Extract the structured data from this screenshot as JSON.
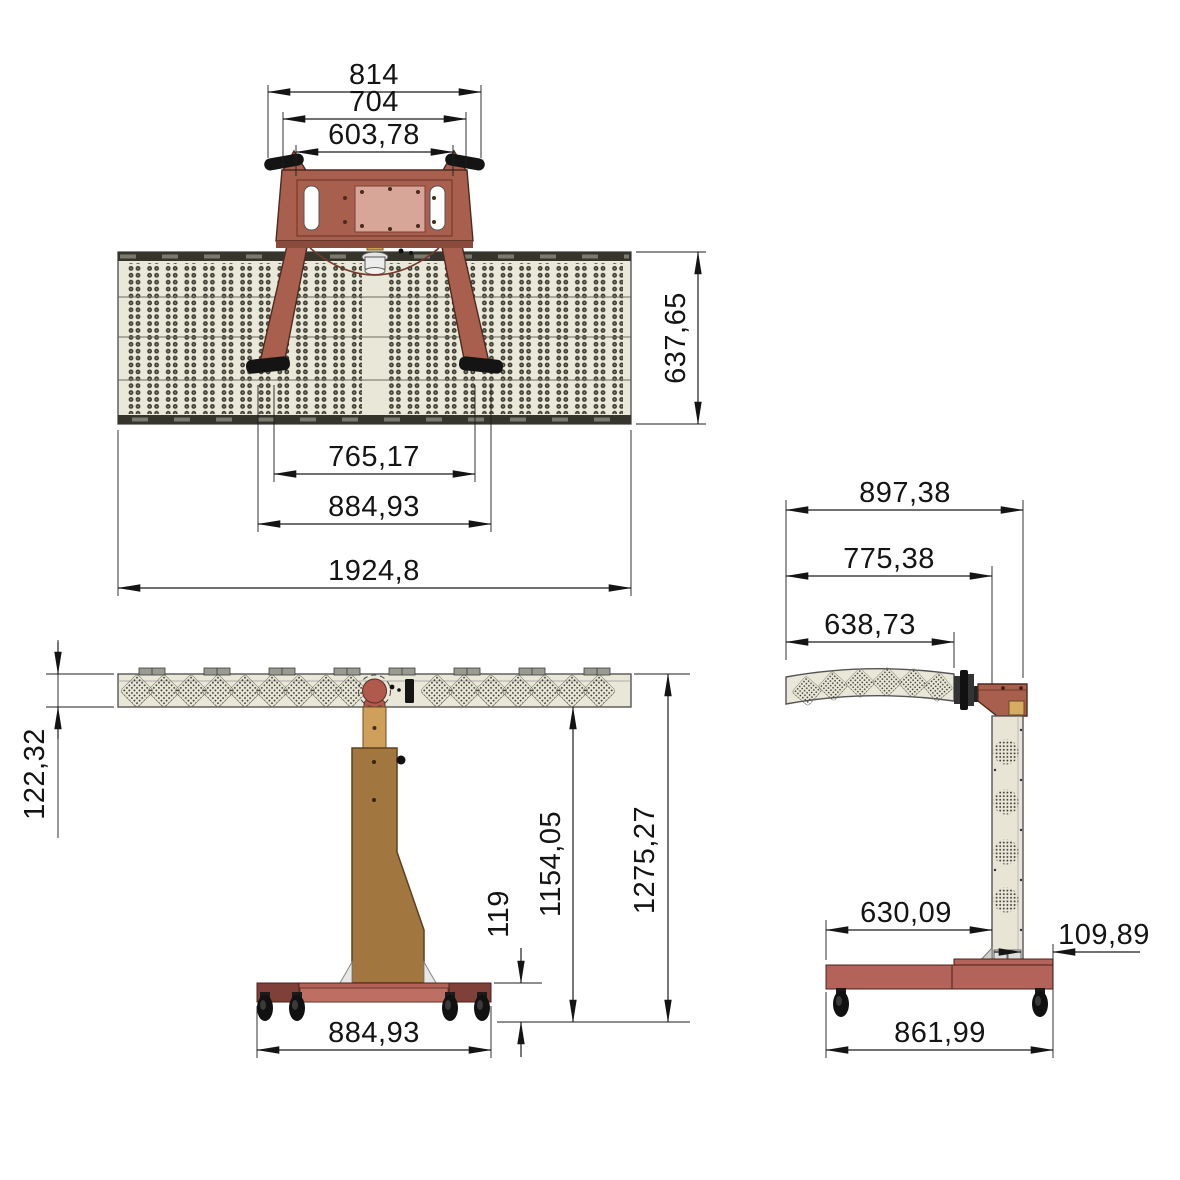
{
  "colors": {
    "bracket_red": "#a85f4e",
    "plate_pink": "#d7a699",
    "panel_cream": "#eae8d9",
    "bar_cream": "#e9e7d8",
    "side_column_cream": "#e8e5d6",
    "column_brown": "#a1773f",
    "adapter_tan": "#cfa05c",
    "base_red": "#b4635a",
    "base_end_dark": "#7e4038",
    "caster_black": "#141414",
    "led_dot": "#3b3b31",
    "dimension_ink": "#141414"
  },
  "views": {
    "top": {
      "dims": {
        "outer_width": "814",
        "bar_width": "704",
        "inner_width": "603,78",
        "panel_depth": "637,65",
        "clamp_span": "765,17",
        "feet_span": "884,93",
        "panel_width": "1924,8"
      }
    },
    "front": {
      "dims": {
        "bar_height": "122,32",
        "under_bar_height": "1154,05",
        "total_height": "1275,27",
        "base_height": "119",
        "base_width": "884,93"
      }
    },
    "side": {
      "dims": {
        "total_depth": "897,38",
        "front_depth": "775,38",
        "panel_depth": "638,73",
        "base_front_span": "630,09",
        "column_depth": "109,89",
        "base_depth": "861,99"
      }
    }
  }
}
